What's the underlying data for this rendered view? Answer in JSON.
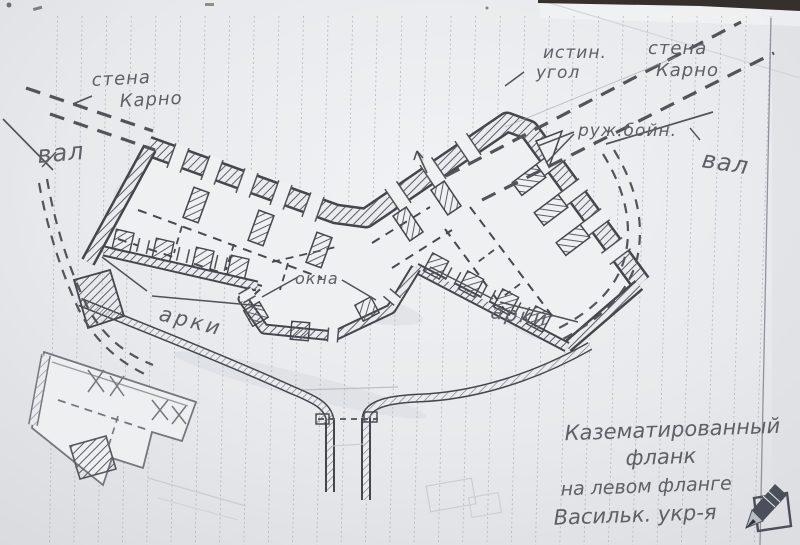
{
  "colors": {
    "paper": "#e7e9ec",
    "rule_line": "#a7acb7",
    "pencil_dark": "#43464c",
    "pencil_mid": "#5d6066",
    "pencil_light": "#8e9198",
    "stamp": "#4a4f5a"
  },
  "labels": {
    "carno_left": {
      "l1": "стена",
      "l2": "Карно"
    },
    "val_left": "вал",
    "true_angle": {
      "l1": "истин.",
      "l2": "угол"
    },
    "carno_right": {
      "l1": "стена",
      "l2": "Карно"
    },
    "rifle_loopholes": "руж.бойн.",
    "val_right": "вал",
    "windows": "окна",
    "arches_left": "арки",
    "arches_right": "арки"
  },
  "caption": {
    "l1": "Казематированный",
    "l2": "фланк",
    "l3": "на левом фланге",
    "l4": "Васильк. укр-я"
  }
}
